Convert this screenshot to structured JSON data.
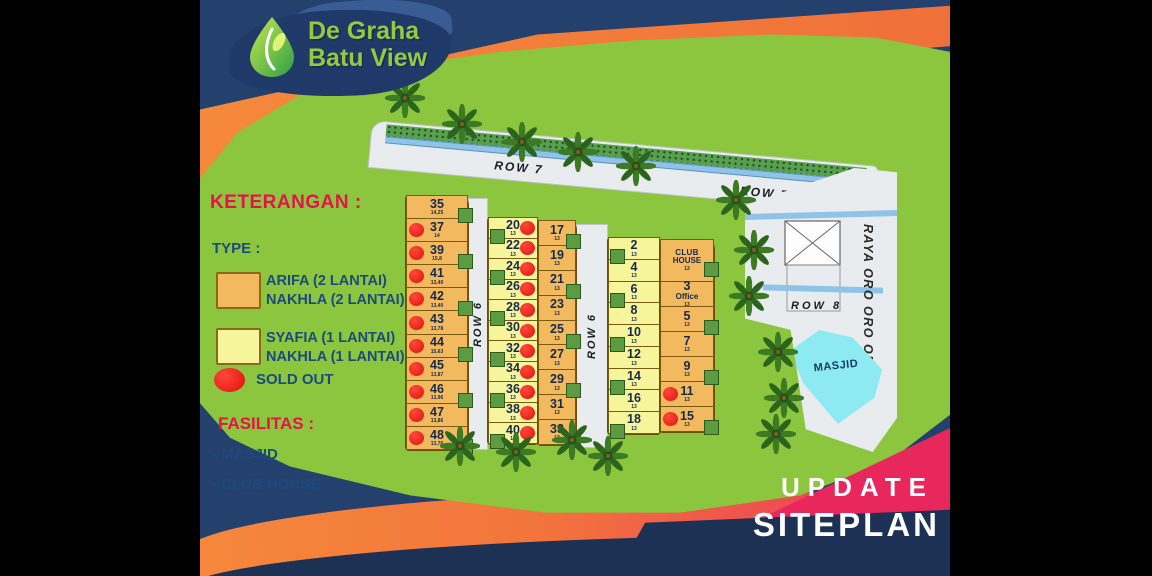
{
  "logo": {
    "line1": "De Graha",
    "line2": "Batu View"
  },
  "legend": {
    "heading": "KETERANGAN :",
    "type_heading": "TYPE :",
    "types": [
      {
        "swatch": "orange",
        "lines": [
          "ARIFA (2 LANTAI)",
          "NAKHLA (2 LANTAI)"
        ]
      },
      {
        "swatch": "yellow",
        "lines": [
          "SYAFIA (1 LANTAI)",
          "NAKHLA (1 LANTAI)"
        ]
      }
    ],
    "sold_out_label": "SOLD OUT",
    "fasilitas_heading": "FASILITAS :",
    "fasilitas_items": [
      "- MASJID",
      "- CLUB HOUSE"
    ]
  },
  "footer": {
    "line1": "UPDATE",
    "line2": "SITEPLAN"
  },
  "map": {
    "labels": {
      "row7_a": "ROW 7",
      "row7_b": "ROW 7",
      "row6": "ROW 6",
      "row8": "ROW 8",
      "main_road": "RAYA ORO ORO OMBO",
      "masjid": "MASJID"
    },
    "strips": [
      {
        "name": "block-left",
        "x": 206,
        "y": 196,
        "w": 62,
        "h": 254,
        "type": "arifa",
        "dot": "left",
        "foot": "right",
        "lots": [
          {
            "n": "35",
            "sub": "14,25",
            "sold": false
          },
          {
            "n": "37",
            "sub": "14",
            "sold": true
          },
          {
            "n": "39",
            "sub": "15,8",
            "sold": true
          },
          {
            "n": "41",
            "sub": "13,40",
            "sold": true
          },
          {
            "n": "42",
            "sub": "13,40",
            "sold": true
          },
          {
            "n": "43",
            "sub": "13,78",
            "sold": true
          },
          {
            "n": "44",
            "sub": "15,63",
            "sold": true
          },
          {
            "n": "45",
            "sub": "13,87",
            "sold": true
          },
          {
            "n": "46",
            "sub": "13,96",
            "sold": true
          },
          {
            "n": "47",
            "sub": "13,86",
            "sold": true
          },
          {
            "n": "48",
            "sub": "13,76",
            "sold": true
          }
        ]
      },
      {
        "name": "block-mid-west",
        "x": 288,
        "y": 218,
        "w": 50,
        "h": 226,
        "type": "syafia",
        "dot": "right",
        "foot": "left",
        "lots": [
          {
            "n": "20",
            "sub": "13",
            "sold": true
          },
          {
            "n": "22",
            "sub": "13",
            "sold": true
          },
          {
            "n": "24",
            "sub": "13",
            "sold": true
          },
          {
            "n": "26",
            "sub": "13",
            "sold": true
          },
          {
            "n": "28",
            "sub": "13",
            "sold": true
          },
          {
            "n": "30",
            "sub": "13",
            "sold": true
          },
          {
            "n": "32",
            "sub": "13",
            "sold": true
          },
          {
            "n": "34",
            "sub": "13",
            "sold": true
          },
          {
            "n": "36",
            "sub": "13",
            "sold": true
          },
          {
            "n": "38",
            "sub": "13",
            "sold": true
          },
          {
            "n": "40",
            "sub": "13",
            "sold": true
          }
        ]
      },
      {
        "name": "block-mid-east",
        "x": 338,
        "y": 221,
        "w": 38,
        "h": 224,
        "type": "arifa",
        "dot": "left",
        "foot": "right",
        "lots": [
          {
            "n": "17",
            "sub": "13",
            "sold": false
          },
          {
            "n": "19",
            "sub": "13",
            "sold": false
          },
          {
            "n": "21",
            "sub": "13",
            "sold": false
          },
          {
            "n": "23",
            "sub": "13",
            "sold": false
          },
          {
            "n": "25",
            "sub": "13",
            "sold": false
          },
          {
            "n": "27",
            "sub": "13",
            "sold": false
          },
          {
            "n": "29",
            "sub": "13",
            "sold": false
          },
          {
            "n": "31",
            "sub": "13",
            "sold": false
          },
          {
            "n": "33",
            "sub": "13",
            "sold": false
          }
        ]
      },
      {
        "name": "block-right-west",
        "x": 408,
        "y": 238,
        "w": 52,
        "h": 196,
        "type": "syafia",
        "dot": "right",
        "foot": "left",
        "lots": [
          {
            "n": "2",
            "sub": "13",
            "sold": false
          },
          {
            "n": "4",
            "sub": "13",
            "sold": false
          },
          {
            "n": "6",
            "sub": "13",
            "sold": false
          },
          {
            "n": "8",
            "sub": "13",
            "sold": false
          },
          {
            "n": "10",
            "sub": "13",
            "sold": false
          },
          {
            "n": "12",
            "sub": "13",
            "sold": false
          },
          {
            "n": "14",
            "sub": "13",
            "sold": false
          },
          {
            "n": "16",
            "sub": "13",
            "sold": false
          },
          {
            "n": "18",
            "sub": "13",
            "sold": false
          }
        ]
      },
      {
        "name": "block-right-east",
        "x": 460,
        "y": 240,
        "w": 54,
        "h": 192,
        "type": "arifa",
        "dot": "left",
        "foot": "right",
        "lots": [
          {
            "n": "CLUB",
            "n2": "HOUSE",
            "sub": "13",
            "sold": false,
            "small": true,
            "g": 1.7
          },
          {
            "n": "3",
            "n2": "Office",
            "sub": "13",
            "sold": false
          },
          {
            "n": "5",
            "sub": "13",
            "sold": false
          },
          {
            "n": "7",
            "sub": "13",
            "sold": false
          },
          {
            "n": "9",
            "sub": "13",
            "sold": false
          },
          {
            "n": "11",
            "sub": "13",
            "sold": true
          },
          {
            "n": "15",
            "sub": "13",
            "sold": true
          }
        ]
      }
    ],
    "trees": [
      [
        205,
        98
      ],
      [
        262,
        124
      ],
      [
        322,
        142
      ],
      [
        378,
        152
      ],
      [
        436,
        166
      ],
      [
        536,
        200
      ],
      [
        554,
        250
      ],
      [
        549,
        296
      ],
      [
        578,
        352
      ],
      [
        584,
        398
      ],
      [
        576,
        434
      ],
      [
        260,
        446
      ],
      [
        316,
        452
      ],
      [
        372,
        440
      ],
      [
        408,
        456
      ]
    ]
  },
  "colors": {
    "navy": "#24406d",
    "navy_dark": "#1d3154",
    "orange": "#f5893b",
    "pink": "#e8285c",
    "green_bg": "#8cc63e",
    "lot_orange": "#f3b95f",
    "lot_yellow": "#f6f59c",
    "house_green": "#5d9b43",
    "sold_red": "#e01010",
    "masjid_cyan": "#8deaf2",
    "road_gray": "#e9ecee",
    "stream_blue": "#8fc3e8",
    "logo_green": "#97c83e",
    "text_navy": "#1c4a7c",
    "text_red": "#e5134a"
  }
}
